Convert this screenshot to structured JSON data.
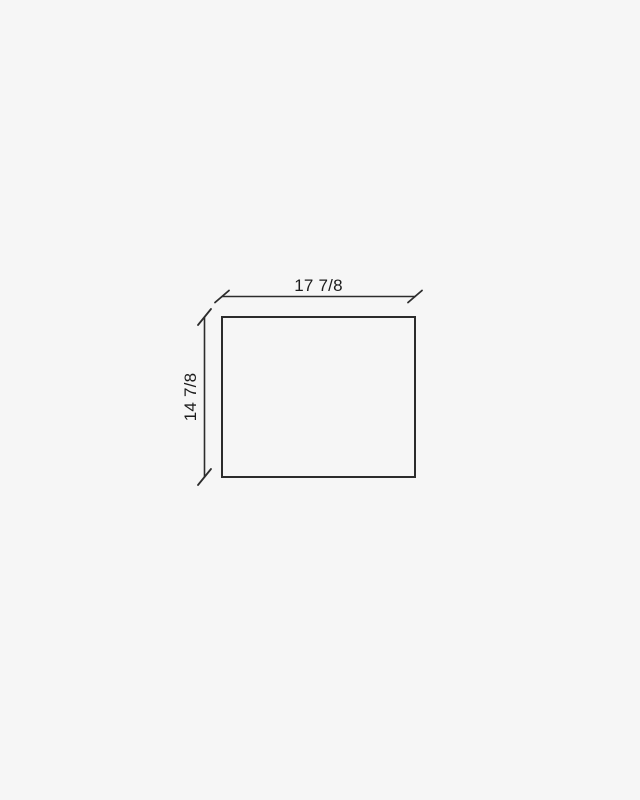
{
  "page": {
    "background": "#f6f6f6"
  },
  "diagram": {
    "type": "dimension-drawing",
    "shape": "rectangle",
    "width_label": "17 7/8",
    "height_label": "14 7/8",
    "line_color": "#2c2c2c",
    "text_color": "#1c1c1c"
  }
}
